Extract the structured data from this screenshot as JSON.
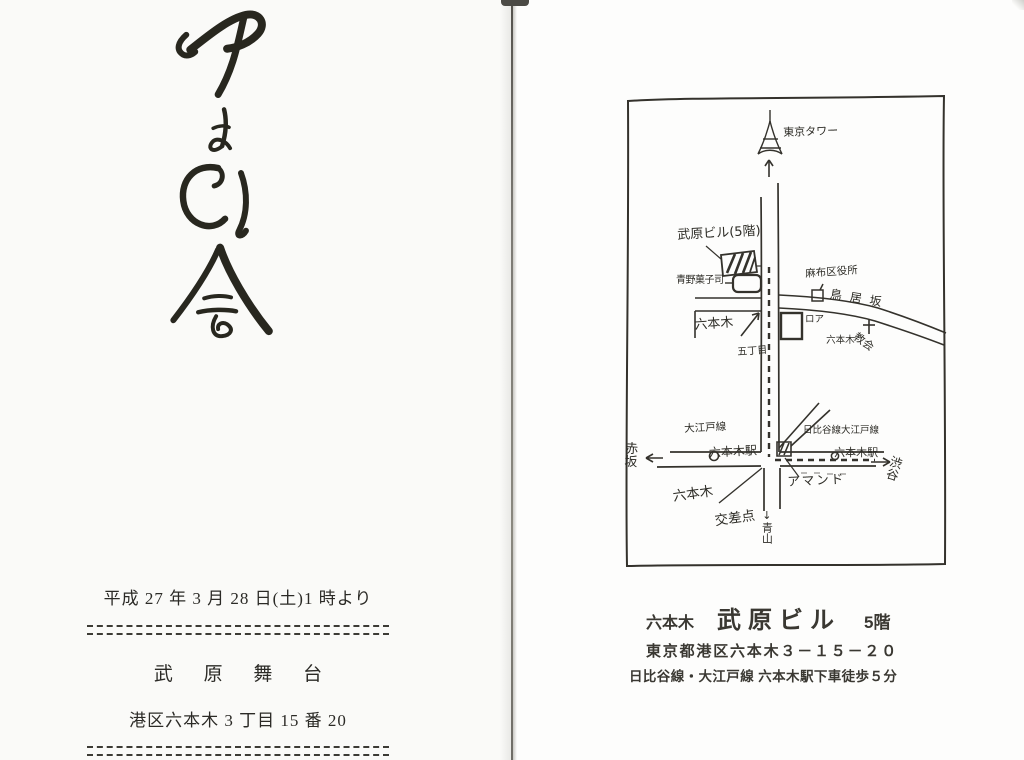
{
  "colors": {
    "ink": "#28271f",
    "map_line": "#34322c",
    "left_page_bg": "#fafaf8",
    "right_page_bg": "#fdfdfc",
    "spine_line": "#6e6c66"
  },
  "left_page": {
    "calligraphy_text": "やよい会",
    "event": {
      "date_line": "平成 27 年 3 月 28 日(土)1 時より",
      "venue_name": "武 原 舞 台",
      "venue_address": "港区六本木 3 丁目 15 番 20"
    }
  },
  "right_page": {
    "map": {
      "labels": {
        "tokyo_tower": "東京タワー",
        "takehara_building": "武原ビル(5階)",
        "aono_confectionery": "青野菓子司",
        "azabu_ward_office": "麻布区役所",
        "toriizaka": "鳥居坂",
        "roppongi_5chome": [
          "六本木",
          "五丁目"
        ],
        "roa_roppongi": [
          "ロア",
          "六本木"
        ],
        "church": "教会",
        "oedo_line_station": [
          "大江戸線",
          "六本木駅"
        ],
        "hibiya_oedo_station": [
          "日比谷線大江戸線",
          "六本木駅"
        ],
        "akasaka": "赤坂",
        "shibuya": "渋谷",
        "almond": "アマンド",
        "roppongi_crossing": [
          "六本木",
          "交差点"
        ],
        "aoyama": "↓青山"
      }
    },
    "address_block": {
      "area": "六本木",
      "building": "武原ビル",
      "floor": "5階",
      "address": "東京都港区六本木３－１５－２０",
      "access": "日比谷線・大江戸線 六本木駅下車徒歩５分"
    }
  }
}
